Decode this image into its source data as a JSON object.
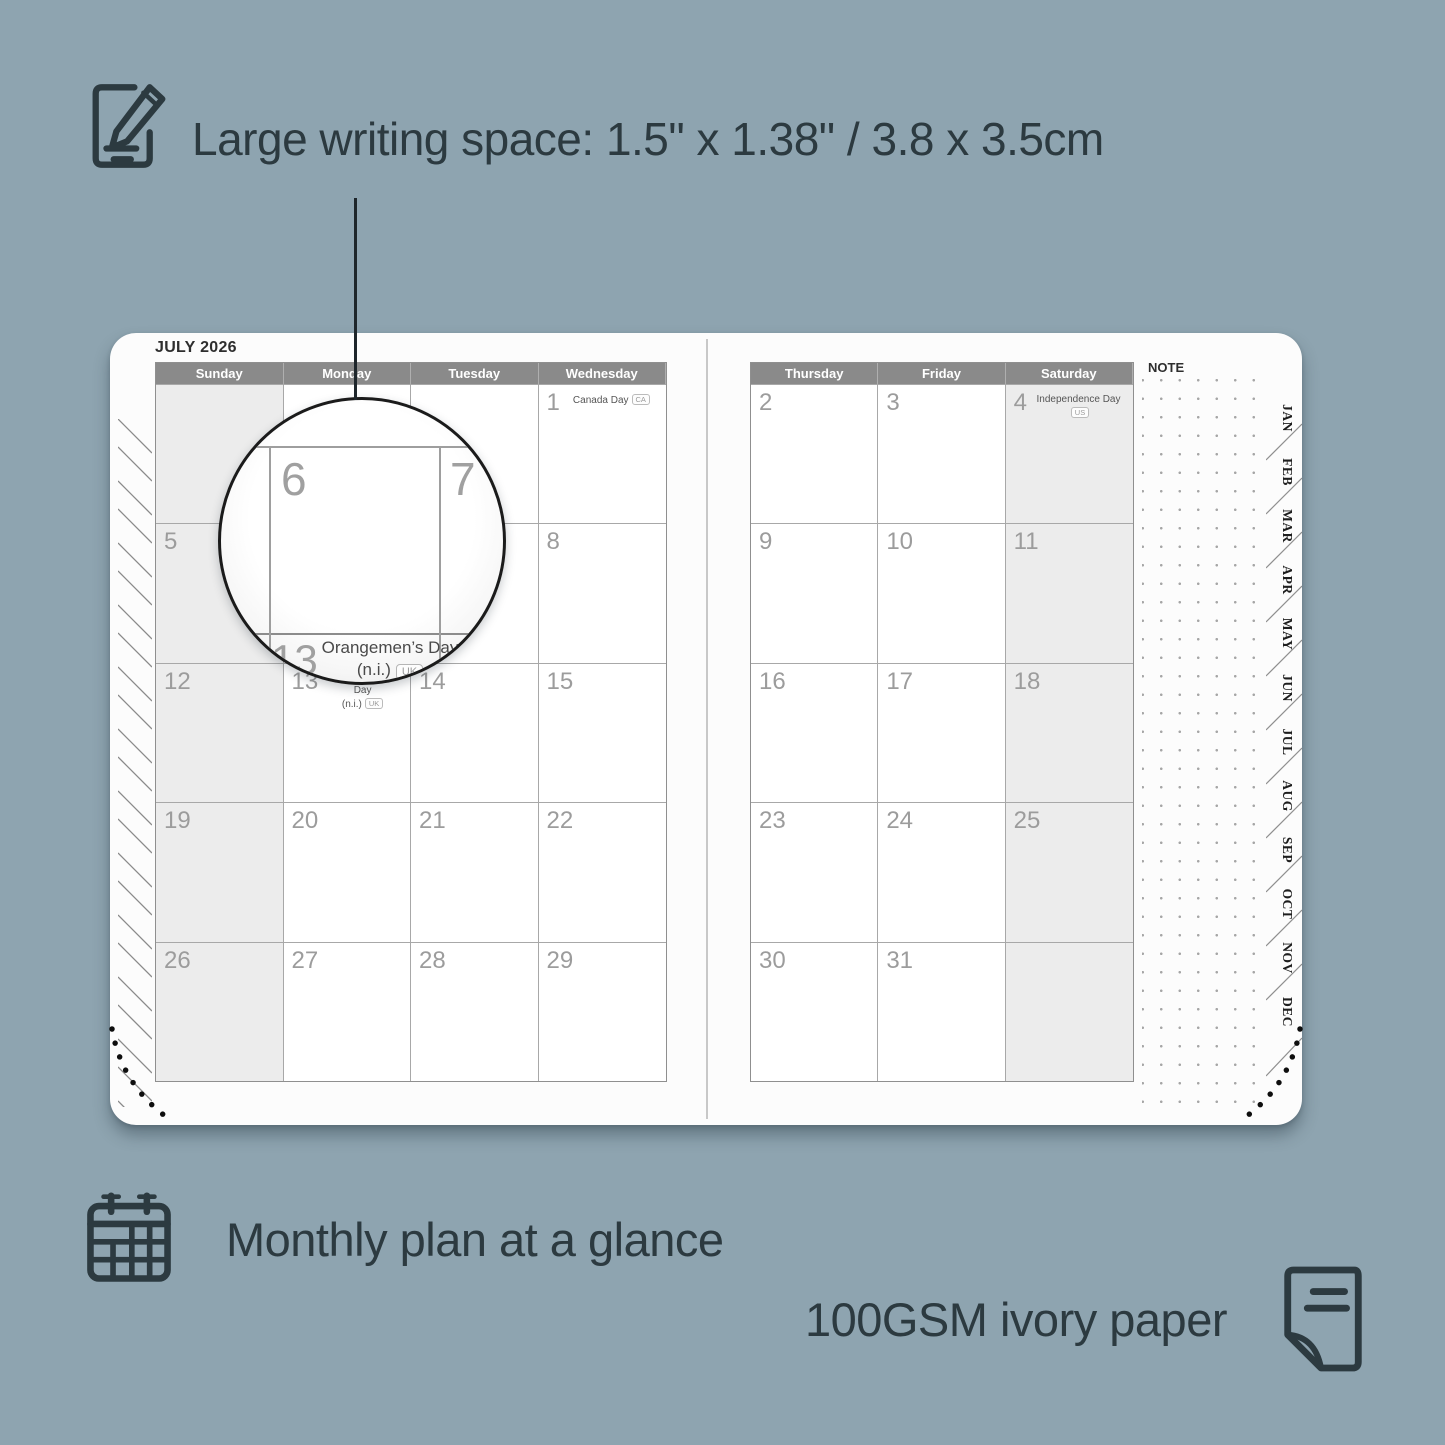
{
  "features": {
    "writing_space": "Large writing space: 1.5\" x 1.38\" / 3.8 x 3.5cm",
    "monthly_plan": "Monthly plan at a glance",
    "paper": "100GSM ivory paper"
  },
  "planner": {
    "title": "JULY 2026",
    "note_label": "NOTE",
    "left_headers": [
      "Sunday",
      "Monday",
      "Tuesday",
      "Wednesday"
    ],
    "right_headers": [
      "Thursday",
      "Friday",
      "Saturday"
    ],
    "left_weeks": [
      [
        {},
        {},
        {},
        {
          "day": "1",
          "event": "Canada Day",
          "badge": "CA"
        }
      ],
      [
        {
          "day": "5"
        },
        {
          "day": "6"
        },
        {
          "day": "7"
        },
        {
          "day": "8"
        }
      ],
      [
        {
          "day": "12"
        },
        {
          "day": "13",
          "event": "Orangemen’s Day\n(n.i.)",
          "badge": "UK"
        },
        {
          "day": "14"
        },
        {
          "day": "15"
        }
      ],
      [
        {
          "day": "19"
        },
        {
          "day": "20"
        },
        {
          "day": "21"
        },
        {
          "day": "22"
        }
      ],
      [
        {
          "day": "26"
        },
        {
          "day": "27"
        },
        {
          "day": "28"
        },
        {
          "day": "29"
        }
      ]
    ],
    "right_weeks": [
      [
        {
          "day": "2"
        },
        {
          "day": "3"
        },
        {
          "day": "4",
          "event": "Independence Day",
          "badge": "US"
        }
      ],
      [
        {
          "day": "9"
        },
        {
          "day": "10"
        },
        {
          "day": "11"
        }
      ],
      [
        {
          "day": "16"
        },
        {
          "day": "17"
        },
        {
          "day": "18"
        }
      ],
      [
        {
          "day": "23"
        },
        {
          "day": "24"
        },
        {
          "day": "25"
        }
      ],
      [
        {
          "day": "30"
        },
        {
          "day": "31"
        },
        {}
      ]
    ],
    "month_tabs": [
      "JAN",
      "FEB",
      "MAR",
      "APR",
      "MAY",
      "JUN",
      "JUL",
      "AUG",
      "SEP",
      "OCT",
      "NOV",
      "DEC"
    ]
  },
  "magnifier": {
    "top_left_day": "6",
    "top_right_day": "7",
    "bottom_day": "13",
    "event": "Orangemen’s Day\n(n.i.)",
    "badge": "UK"
  },
  "colors": {
    "background": "#8EA4B0",
    "text": "#2C3A40",
    "header_bg": "#8A8A8A",
    "weekend_bg": "#ECECEC"
  }
}
